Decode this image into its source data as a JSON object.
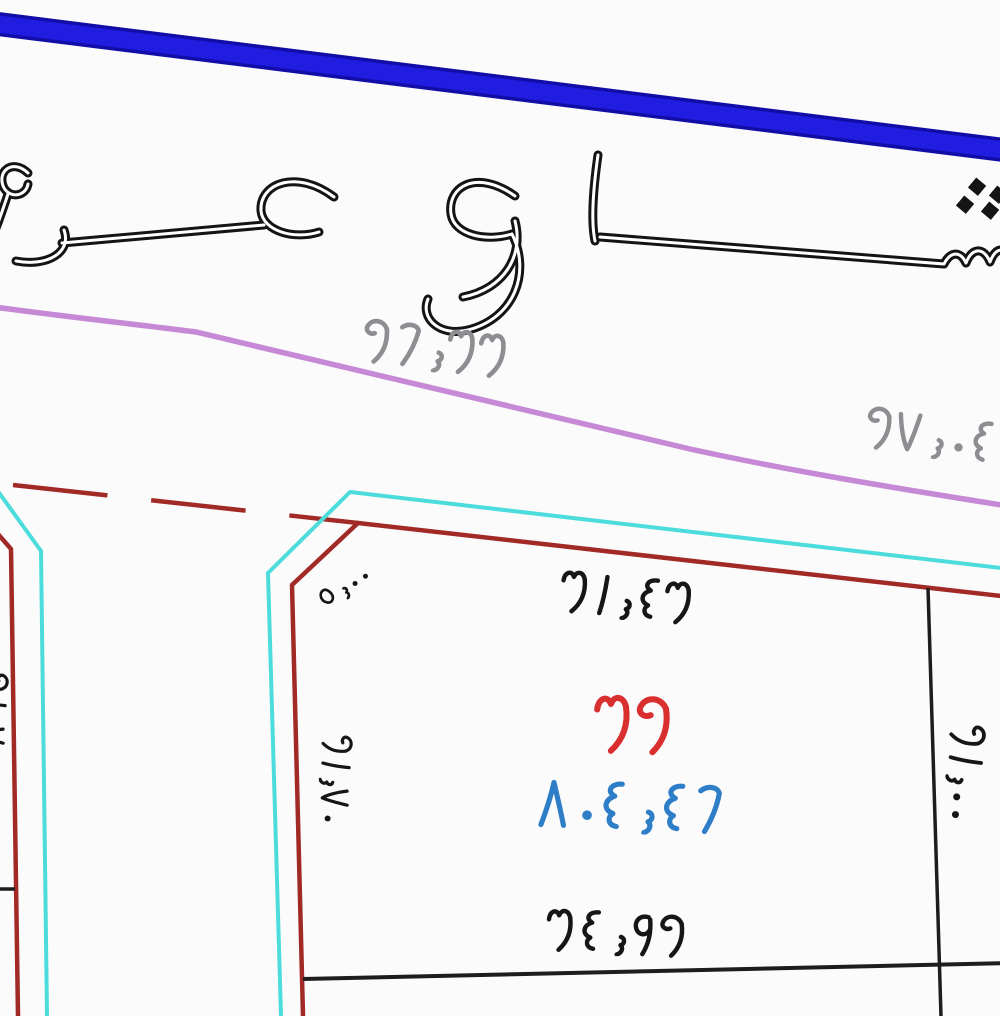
{
  "street": {
    "label": "شارع عرض",
    "truncated": true
  },
  "curb_annotations": {
    "left_value": "٢٦٫٣٣",
    "right_value": "٢٧٫٠٤"
  },
  "plot": {
    "number": "٣٢",
    "area": "٨٠٤٫٤٦",
    "front_width": "٣١٫٤٣",
    "rear_width": "٣٤٫٩٢",
    "left_side": "٢١٫٧٠",
    "right_side": "٢١٫٠٠",
    "corner_chamfer": "٥٫٠٠"
  },
  "neighbor_plot": {
    "side_partial": "٢١٫٧٠"
  },
  "colors": {
    "street_edge_blue": "#201ce0",
    "street_edge_blue_dark": "#110da6",
    "curb_violet": "#c689d6",
    "boundary_cyan": "#4cdcdc",
    "boundary_red": "#a22a26",
    "line_black": "#1d1d1d",
    "text_gray": "#8e8e92",
    "text_black": "#161616",
    "plot_number_red": "#d92f2f",
    "area_blue": "#2d7dc7"
  }
}
